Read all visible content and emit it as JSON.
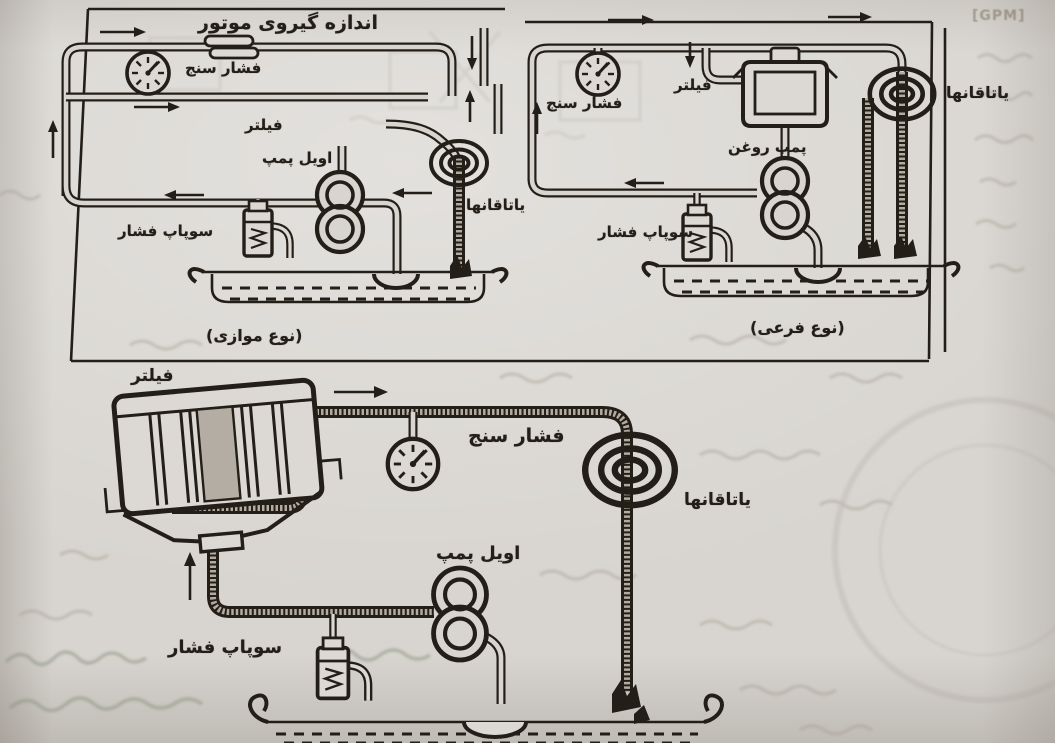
{
  "figure": {
    "gpm_note": "[GPM]",
    "top_left": {
      "title": "اندازه گیروی موتور",
      "caption": "(نوع موازی)",
      "labels": {
        "gauge": "فشار سنج",
        "filter": "فیلتر",
        "pump": "اویل پمپ",
        "valve": "سوپاپ فشار",
        "bearings": "یاتاقانها"
      }
    },
    "top_right": {
      "caption": "(نوع فرعی)",
      "labels": {
        "gauge": "فشار سنج",
        "filter": "فیلتر",
        "pump": "پمپ روغن",
        "valve": "سوپاپ فشار",
        "bearings": "یاتاقانها"
      }
    },
    "bottom": {
      "labels": {
        "filter": "فیلتر",
        "gauge": "فشار سنج",
        "pump": "اویل پمپ",
        "valve": "سوپاپ فشار",
        "bearings": "یاتاقانها"
      }
    },
    "colors": {
      "ink": "#241e18",
      "paper": "#d8d5d0",
      "bleed": "#a8a295"
    }
  }
}
